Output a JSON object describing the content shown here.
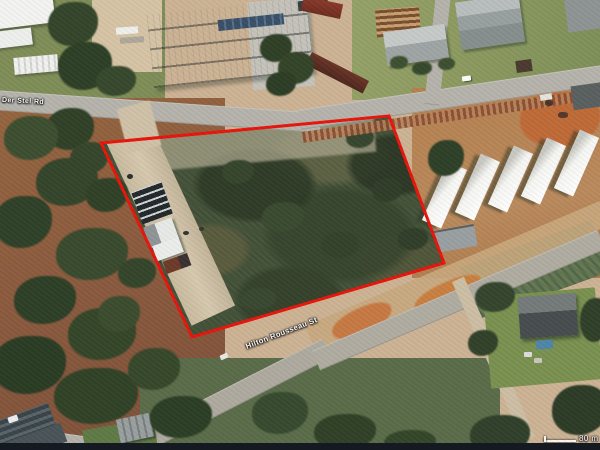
{
  "map": {
    "description": "Aerial satellite view of a vacant land parcel outlined in red",
    "roads": {
      "top_road_label": "Van Der Stel Rd",
      "bottom_road_label": "Hilton Rousseau St"
    },
    "scale_bar": {
      "label": "80 m"
    },
    "boundary": {
      "color": "#e8150b",
      "stroke_width": 3,
      "points": "101,143 389,116 444,263 192,337"
    },
    "colors": {
      "scrub_green": "#46543a",
      "soil_tan": "#cdb394",
      "soil_orange": "#c06a38",
      "road_grey": "#b5b3ab",
      "roof_white": "#f4f4f2",
      "roof_red": "#7e3326",
      "letterbox_bar": "#141922"
    }
  }
}
